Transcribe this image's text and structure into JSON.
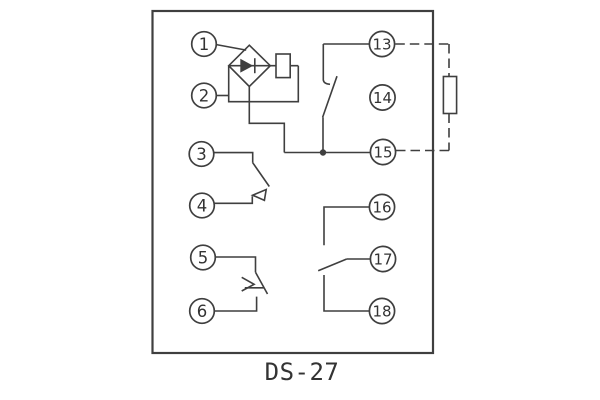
{
  "page": {
    "background_color": "#ffffff"
  },
  "diagram": {
    "model_label": "DS-27",
    "line_color": "#3f3f3f",
    "text_color": "#333333",
    "terminals": {
      "t1": "1",
      "t2": "2",
      "t3": "3",
      "t4": "4",
      "t5": "5",
      "t6": "6",
      "t13": "13",
      "t14": "14",
      "t15": "15",
      "t16": "16",
      "t17": "17",
      "t18": "18"
    }
  }
}
